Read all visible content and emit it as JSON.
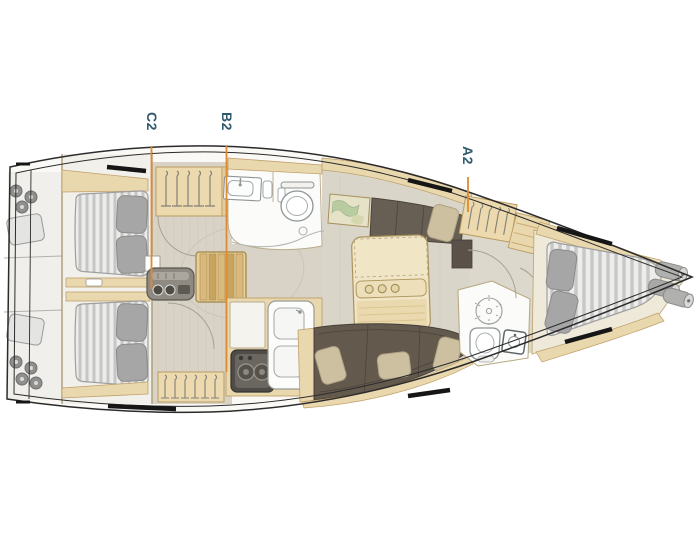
{
  "diagram": {
    "type": "sailboat-interior-layout-plan",
    "orientation": {
      "bow": "right",
      "stern": "left"
    },
    "section_markers": [
      {
        "label": "C2"
      },
      {
        "label": "B2"
      },
      {
        "label": "A2"
      }
    ],
    "areas": [
      "aft-cabin-port",
      "aft-cabin-starboard",
      "companionway",
      "aft-head",
      "galley",
      "saloon",
      "nav-station",
      "forward-head",
      "forward-cabin",
      "stern-locker",
      "bow-locker"
    ],
    "icons": [
      "steering-gear-icon",
      "hangers-icon",
      "companionway-steps-icon",
      "engine-unit-icon",
      "sink-icon",
      "toilet-icon",
      "towel-rail-icon",
      "shower-drain-icon",
      "stove-icon",
      "double-sink-icon",
      "chart-map-icon",
      "cup-holders-icon",
      "bed-mattress-icon",
      "pillow-icon",
      "sofa-icon",
      "fenders-icon",
      "door-swing-icon",
      "deck-hatch-icon"
    ],
    "colors": {
      "marker_line": "#de8a33",
      "marker_text": "#2f5a6e",
      "hull_line": "#2b2b2b",
      "wood": "#e9d7ad",
      "wood_dark": "#b0945f",
      "floor": "#d9d4c8",
      "mattress": "#ececea",
      "mattress_stripe": "#c6c6c6",
      "pillow_gray": "#a6a6a6",
      "sofa_brown": "#63594d",
      "sofa_pillow": "#ccc0a0",
      "fixture_white": "#fcfcfa",
      "gear_gray": "#8f8f8d"
    }
  }
}
